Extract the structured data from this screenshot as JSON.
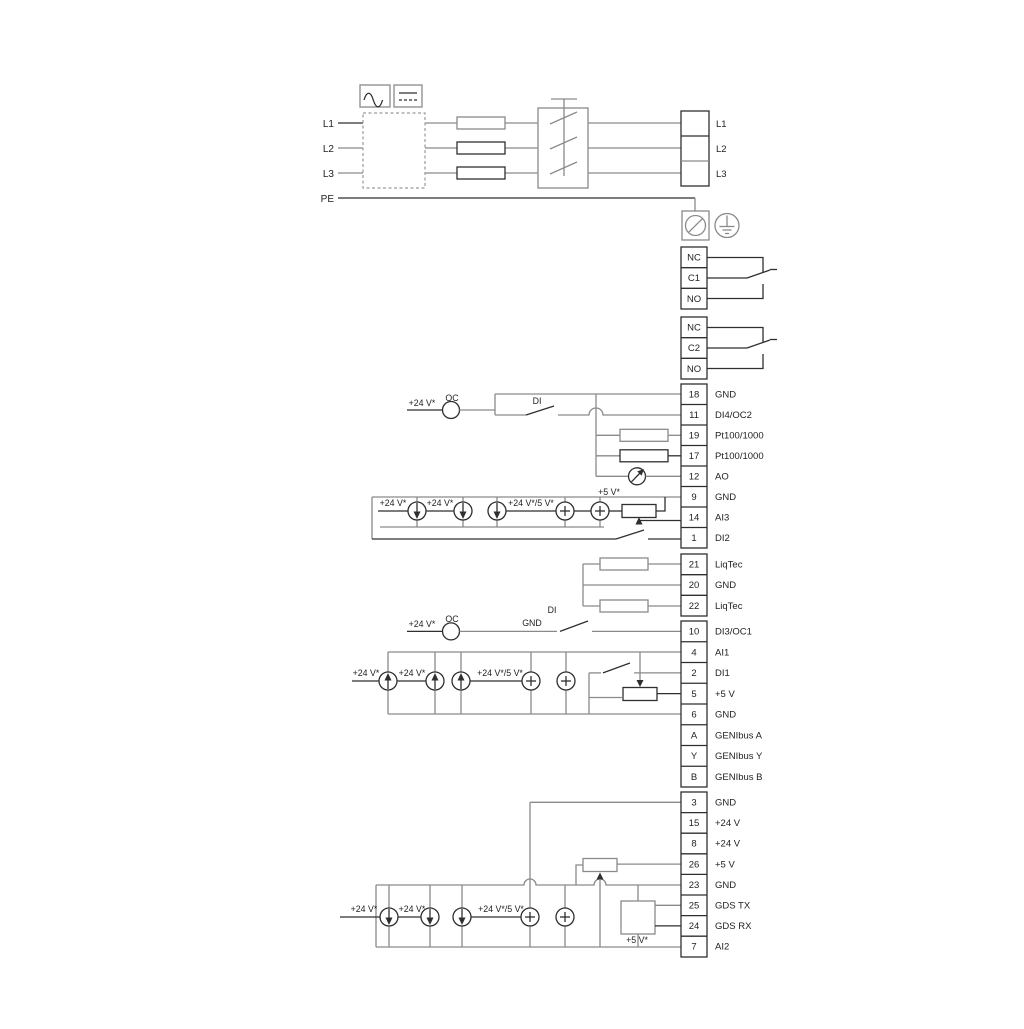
{
  "labels": {
    "v24": "+24 V*",
    "v24_5": "+24 V*/5 V*",
    "v5": "+5 V*",
    "oc": "OC",
    "di": "DI",
    "gnd": "GND"
  },
  "mains": {
    "inputs": [
      "L1",
      "L2",
      "L3"
    ],
    "pe": "PE",
    "outputs": [
      "L1",
      "L2",
      "L3"
    ]
  },
  "relay1": [
    "NC",
    "C1",
    "NO"
  ],
  "relay2": [
    "NC",
    "C2",
    "NO"
  ],
  "io1": [
    {
      "num": "18",
      "label": "GND"
    },
    {
      "num": "11",
      "label": "DI4/OC2"
    },
    {
      "num": "19",
      "label": "Pt100/1000"
    },
    {
      "num": "17",
      "label": "Pt100/1000"
    },
    {
      "num": "12",
      "label": "AO"
    },
    {
      "num": "9",
      "label": "GND"
    },
    {
      "num": "14",
      "label": "AI3"
    },
    {
      "num": "1",
      "label": "DI2"
    }
  ],
  "liqtec": [
    {
      "num": "21",
      "label": "LiqTec"
    },
    {
      "num": "20",
      "label": "GND"
    },
    {
      "num": "22",
      "label": "LiqTec"
    }
  ],
  "io2": [
    {
      "num": "10",
      "label": "DI3/OC1"
    },
    {
      "num": "4",
      "label": "AI1"
    },
    {
      "num": "2",
      "label": "DI1"
    },
    {
      "num": "5",
      "label": "+5 V"
    },
    {
      "num": "6",
      "label": "GND"
    },
    {
      "num": "A",
      "label": "GENIbus A"
    },
    {
      "num": "Y",
      "label": "GENIbus Y"
    },
    {
      "num": "B",
      "label": "GENIbus B"
    }
  ],
  "io3": [
    {
      "num": "3",
      "label": "GND"
    },
    {
      "num": "15",
      "label": "+24 V"
    },
    {
      "num": "8",
      "label": "+24 V"
    },
    {
      "num": "26",
      "label": "+5 V"
    },
    {
      "num": "23",
      "label": "GND"
    },
    {
      "num": "25",
      "label": "GDS TX"
    },
    {
      "num": "24",
      "label": "GDS RX"
    },
    {
      "num": "7",
      "label": "AI2"
    }
  ],
  "colors": {
    "background": "#ffffff",
    "wire_gray": "#8a8a8a",
    "ink": "#2f2f2f"
  }
}
